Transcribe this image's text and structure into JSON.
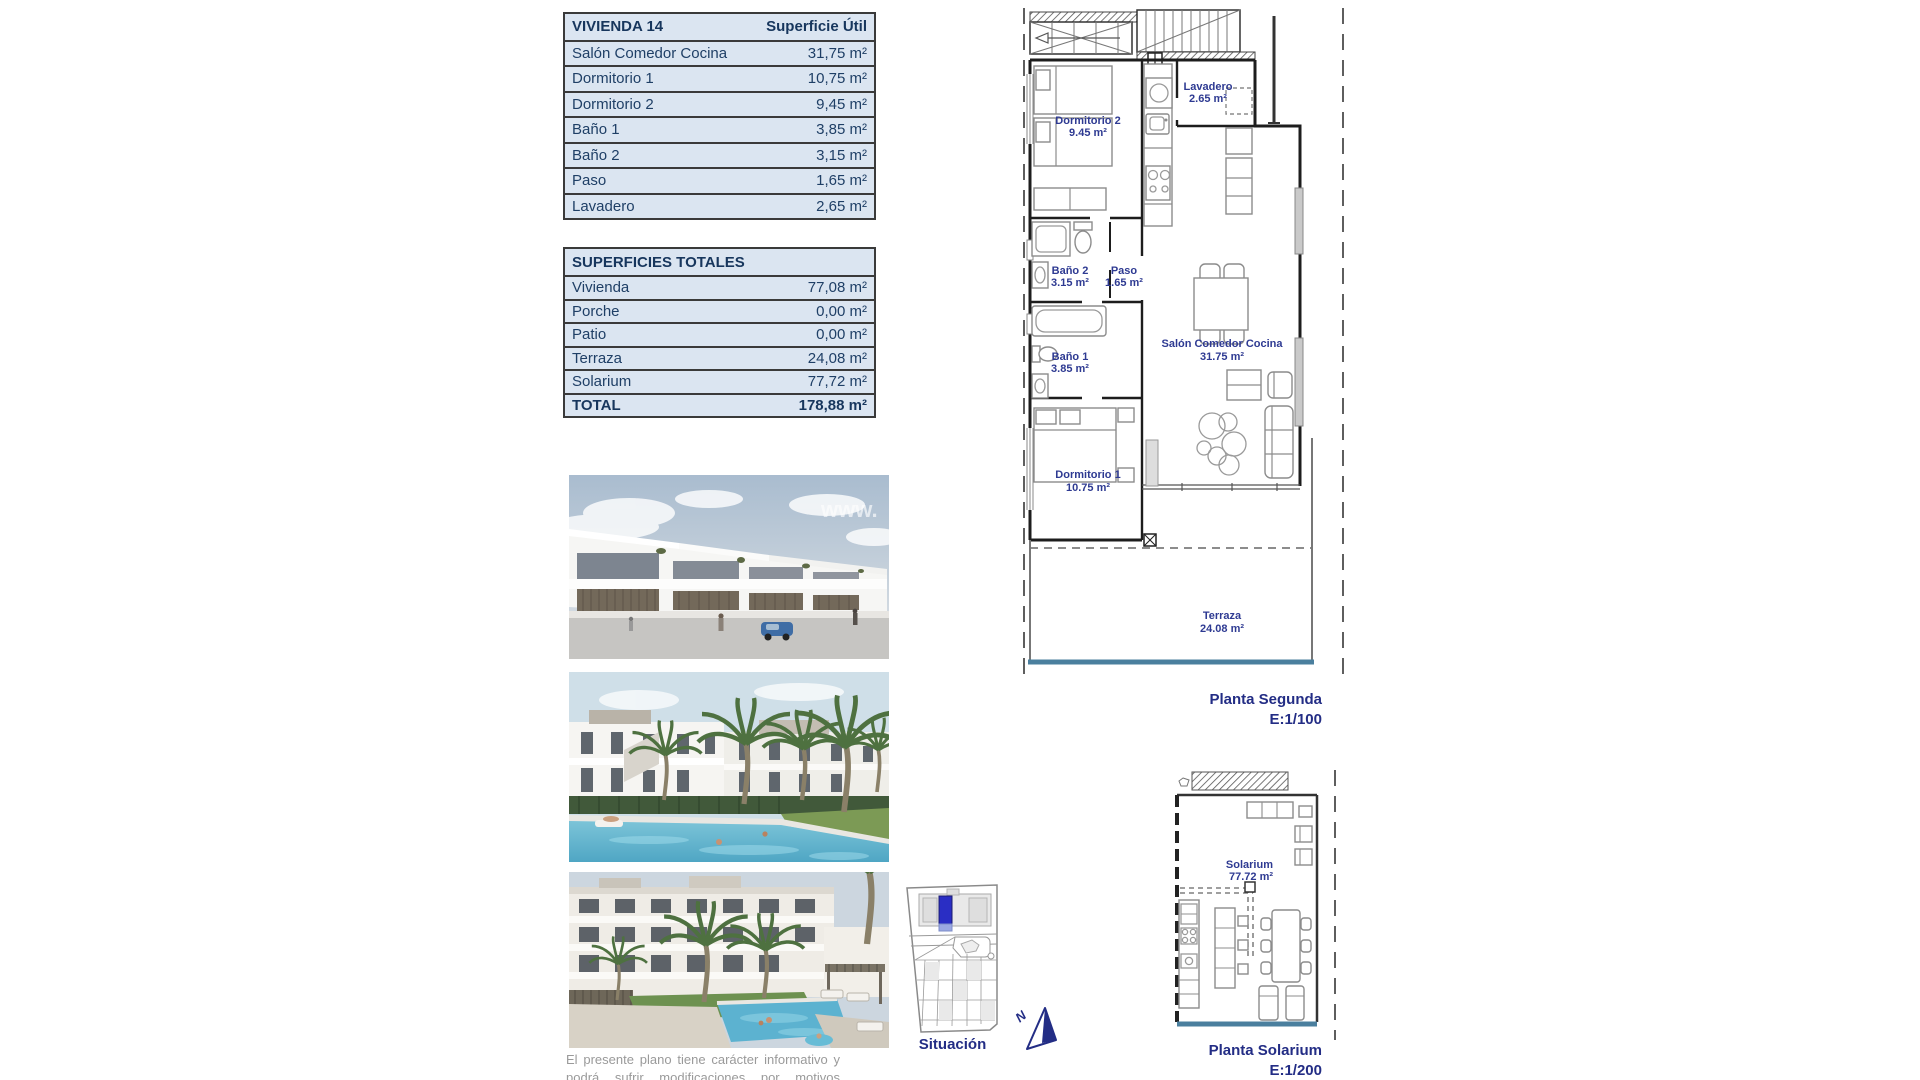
{
  "tables": {
    "vivienda": {
      "title": "VIVIENDA 14",
      "col_header": "Superficie Útil",
      "rows": [
        {
          "label": "Salón Comedor Cocina",
          "value": "31,75 m²"
        },
        {
          "label": "Dormitorio 1",
          "value": "10,75 m²"
        },
        {
          "label": "Dormitorio 2",
          "value": "9,45 m²"
        },
        {
          "label": "Baño 1",
          "value": "3,85 m²"
        },
        {
          "label": "Baño 2",
          "value": "3,15 m²"
        },
        {
          "label": "Paso",
          "value": "1,65 m²"
        },
        {
          "label": "Lavadero",
          "value": "2,65 m²"
        }
      ]
    },
    "totales": {
      "title": "SUPERFICIES TOTALES",
      "rows": [
        {
          "label": "Vivienda",
          "value": "77,08 m²"
        },
        {
          "label": "Porche",
          "value": "0,00 m²"
        },
        {
          "label": "Patio",
          "value": "0,00 m²"
        },
        {
          "label": "Terraza",
          "value": "24,08 m²"
        },
        {
          "label": "Solarium",
          "value": "77,72 m²"
        }
      ],
      "total": {
        "label": "TOTAL",
        "value": "178,88 m²"
      }
    }
  },
  "plans": {
    "segunda": {
      "caption": "Planta Segunda",
      "scale": "E:1/100",
      "rooms": {
        "dormitorio2": {
          "name": "Dormitorio 2",
          "area": "9.45 m²"
        },
        "lavadero": {
          "name": "Lavadero",
          "area": "2.65 m²"
        },
        "bano2": {
          "name": "Baño 2",
          "area": "3.15 m²"
        },
        "paso": {
          "name": "Paso",
          "area": "1.65 m²"
        },
        "bano1": {
          "name": "Baño 1",
          "area": "3.85 m²"
        },
        "salon": {
          "name": "Salón Comedor Cocina",
          "area": "31.75 m²"
        },
        "dormitorio1": {
          "name": "Dormitorio 1",
          "area": "10.75 m²"
        },
        "terraza": {
          "name": "Terraza",
          "area": "24.08 m²"
        }
      }
    },
    "solarium": {
      "caption": "Planta Solarium",
      "scale": "E:1/200",
      "room": {
        "name": "Solarium",
        "area": "77.72 m²"
      }
    }
  },
  "situacion": {
    "label": "Situación",
    "north": "N"
  },
  "watermark": "www.",
  "disclaimer": "El presente plano tiene carácter informativo y podrá sufrir modificaciones por motivos técnicos o jurídicos.",
  "colors": {
    "table_bg": "#dbe5f1",
    "navy_text": "#1f3f66",
    "plan_label": "#2e3a92",
    "terrace_edge": "#4a7f9e",
    "situacion_highlight": "#2a2ec4"
  }
}
